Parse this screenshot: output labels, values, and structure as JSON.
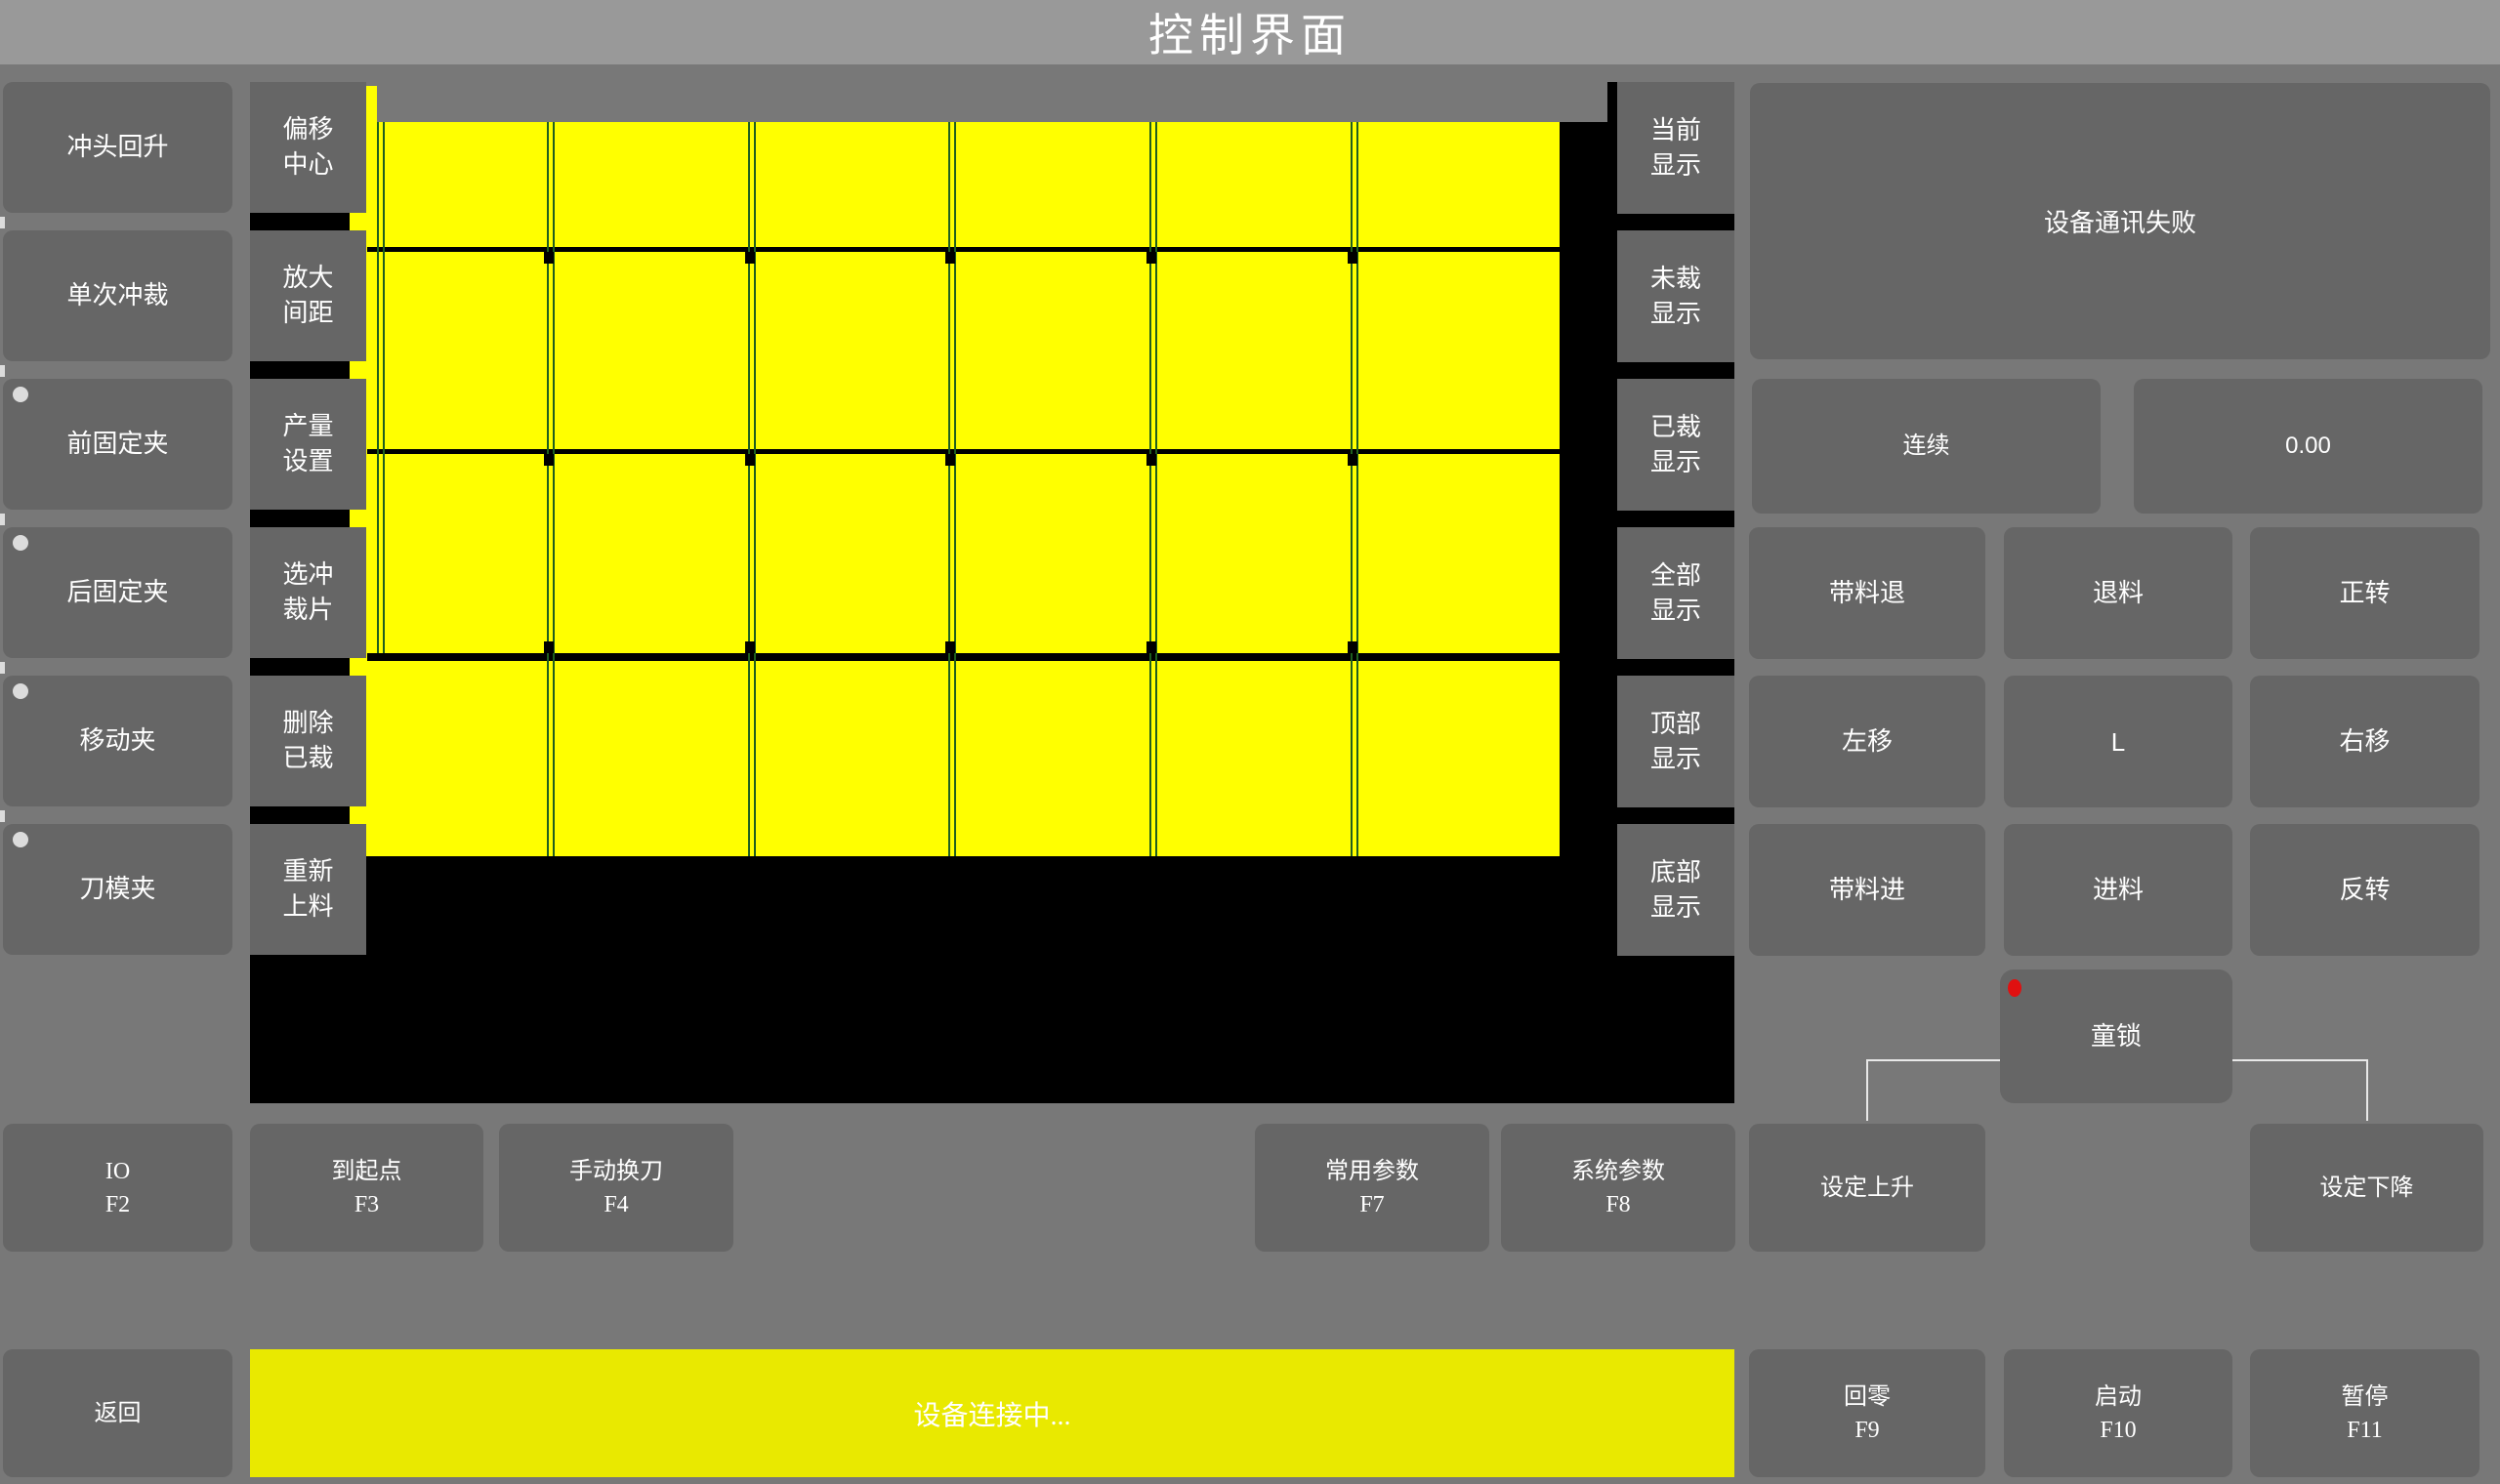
{
  "title_bar": {
    "title": "控制界面"
  },
  "left_sidebar": {
    "buttons": [
      {
        "label": "冲头回升",
        "indicator": false
      },
      {
        "label": "单次冲裁",
        "indicator": false
      },
      {
        "label": "前固定夹",
        "indicator": true
      },
      {
        "label": "后固定夹",
        "indicator": true
      },
      {
        "label": "移动夹",
        "indicator": true
      },
      {
        "label": "刀模夹",
        "indicator": true
      }
    ]
  },
  "tool_column": {
    "buttons": [
      {
        "line1": "偏移",
        "line2": "中心"
      },
      {
        "line1": "放大",
        "line2": "间距"
      },
      {
        "line1": "产量",
        "line2": "设置"
      },
      {
        "line1": "选冲",
        "line2": "裁片"
      },
      {
        "line1": "删除",
        "line2": "已裁"
      },
      {
        "line1": "重新",
        "line2": "上料"
      }
    ]
  },
  "display_column": {
    "buttons": [
      {
        "line1": "当前",
        "line2": "显示"
      },
      {
        "line1": "未裁",
        "line2": "显示"
      },
      {
        "line1": "已裁",
        "line2": "显示"
      },
      {
        "line1": "全部",
        "line2": "显示"
      },
      {
        "line1": "顶部",
        "line2": "显示"
      },
      {
        "line1": "底部",
        "line2": "显示"
      }
    ]
  },
  "preview": {
    "grid_columns": 6,
    "grid_rows": 4
  },
  "right_panel": {
    "message": "设备通讯失败",
    "mode_button": "连续",
    "value_display": "0.00",
    "jog_grid": {
      "rows": [
        [
          "带料退",
          "退料",
          "正转"
        ],
        [
          "左移",
          "L",
          "右移"
        ],
        [
          "带料进",
          "进料",
          "反转"
        ]
      ]
    },
    "child_lock": "童锁"
  },
  "function_row": {
    "buttons": [
      {
        "label": "IO",
        "key": "F2"
      },
      {
        "label": "到起点",
        "key": "F3"
      },
      {
        "label": "手动换刀",
        "key": "F4"
      },
      {
        "label": "常用参数",
        "key": "F7"
      },
      {
        "label": "系统参数",
        "key": "F8"
      },
      {
        "label": "设定上升",
        "key": ""
      },
      {
        "label": "设定下降",
        "key": ""
      }
    ]
  },
  "bottom_bar": {
    "back_button": "返回",
    "status_message": "设备连接中...",
    "buttons": [
      {
        "label": "回零",
        "key": "F9"
      },
      {
        "label": "启动",
        "key": "F10"
      },
      {
        "label": "暂停",
        "key": "F11"
      }
    ]
  },
  "colors": {
    "background": "#787878",
    "titlebar": "#999999",
    "button": "#666666",
    "canvas": "#000000",
    "sheet_yellow": "#ffff00",
    "status_yellow": "#e9e900",
    "grid_line_green": "#1f5f1f",
    "alert_red": "#e01010",
    "text": "#ffffff"
  }
}
